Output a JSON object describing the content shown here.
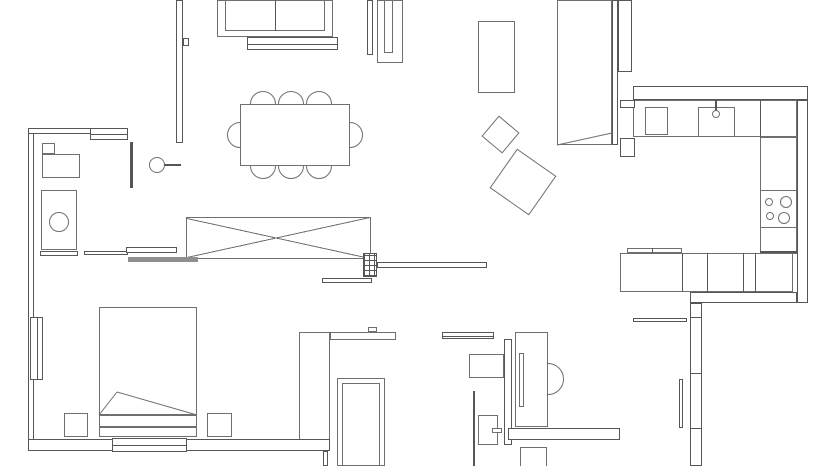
{
  "canvas": {
    "width": 840,
    "height": 466,
    "background": "#ffffff",
    "wall_color": "#565656",
    "furniture_color": "#6f6f6f",
    "gray_fill": "#8f8f8f"
  },
  "elements": [
    {
      "name": "left-exterior-wall",
      "type": "wall",
      "x": 28,
      "y": 128,
      "w": 6,
      "h": 317,
      "layer": 4
    },
    {
      "name": "bathroom-top-wall",
      "type": "wall",
      "x": 28,
      "y": 128,
      "w": 100,
      "h": 6,
      "layer": 4
    },
    {
      "name": "top-window",
      "type": "window-h",
      "x": 90,
      "y": 128,
      "w": 38,
      "h": 12,
      "layer": 5
    },
    {
      "name": "living-divider-wall",
      "type": "wall",
      "x": 176,
      "y": 0,
      "w": 7,
      "h": 143,
      "layer": 4
    },
    {
      "name": "divider-notch",
      "type": "wall",
      "x": 183,
      "y": 38,
      "w": 6,
      "h": 8,
      "layer": 4
    },
    {
      "name": "entry-door-jamb",
      "type": "wall",
      "x": 612,
      "y": 0,
      "w": 6,
      "h": 145,
      "layer": 4
    },
    {
      "name": "kitchen-left-wall",
      "type": "wall",
      "x": 618,
      "y": 0,
      "w": 14,
      "h": 72,
      "layer": 4
    },
    {
      "name": "kitchen-top-wall",
      "type": "wall",
      "x": 633,
      "y": 86,
      "w": 175,
      "h": 14,
      "layer": 4
    },
    {
      "name": "right-exterior-wall",
      "type": "wall",
      "x": 797,
      "y": 100,
      "w": 11,
      "h": 203,
      "layer": 4
    },
    {
      "name": "balcony-wall-horizontal",
      "type": "wall",
      "x": 690,
      "y": 292,
      "w": 107,
      "h": 11,
      "layer": 4
    },
    {
      "name": "balcony-wall-vertical",
      "type": "wall",
      "x": 690,
      "y": 303,
      "w": 12,
      "h": 163,
      "layer": 4
    },
    {
      "name": "balcony-wall-tick-1",
      "type": "solid",
      "x": 690,
      "y": 317,
      "w": 12,
      "h": 1,
      "layer": 5
    },
    {
      "name": "balcony-wall-tick-2",
      "type": "solid",
      "x": 690,
      "y": 373,
      "w": 12,
      "h": 1,
      "layer": 5
    },
    {
      "name": "balcony-wall-tick-3",
      "type": "solid",
      "x": 690,
      "y": 428,
      "w": 12,
      "h": 1,
      "layer": 5
    },
    {
      "name": "bottom-exterior-wall",
      "type": "wall",
      "x": 28,
      "y": 439,
      "w": 302,
      "h": 12,
      "layer": 4
    },
    {
      "name": "bottom-window",
      "type": "window-h",
      "x": 112,
      "y": 438,
      "w": 75,
      "h": 14,
      "layer": 5
    },
    {
      "name": "left-window",
      "type": "window-v",
      "x": 30,
      "y": 317,
      "w": 13,
      "h": 63,
      "layer": 5
    },
    {
      "name": "bottom-step-wall",
      "type": "wall",
      "x": 323,
      "y": 451,
      "w": 5,
      "h": 15,
      "layer": 4
    },
    {
      "name": "wc-left-wall",
      "type": "solid",
      "x": 473,
      "y": 391,
      "w": 2,
      "h": 75,
      "layer": 4
    },
    {
      "name": "wc-mid-wall",
      "type": "wall",
      "x": 504,
      "y": 339,
      "w": 8,
      "h": 106,
      "layer": 4
    },
    {
      "name": "wc-bottom-wall",
      "type": "wall",
      "x": 508,
      "y": 428,
      "w": 112,
      "h": 12,
      "layer": 4
    },
    {
      "name": "kitchen-entry-block-a",
      "type": "wall",
      "x": 620,
      "y": 100,
      "w": 15,
      "h": 8,
      "layer": 4
    },
    {
      "name": "kitchen-entry-block-b",
      "type": "wall",
      "x": 620,
      "y": 138,
      "w": 15,
      "h": 19,
      "layer": 4
    },
    {
      "name": "bathroom-partition",
      "type": "solid",
      "x": 130,
      "y": 142,
      "w": 3,
      "h": 46,
      "layer": 4
    },
    {
      "name": "sliding-door-panel-a",
      "type": "wall",
      "x": 84,
      "y": 251,
      "w": 44,
      "h": 4,
      "layer": 5
    },
    {
      "name": "sliding-door-panel-b",
      "type": "wall",
      "x": 126,
      "y": 247,
      "w": 51,
      "h": 6,
      "layer": 5
    },
    {
      "name": "sliding-door-panel-c",
      "type": "solid-gray",
      "x": 128,
      "y": 257,
      "w": 70,
      "h": 5,
      "layer": 5
    },
    {
      "name": "bathroom-bench",
      "type": "wall",
      "x": 40,
      "y": 251,
      "w": 38,
      "h": 5,
      "layer": 5
    },
    {
      "name": "hall-wall-bar",
      "type": "wall",
      "x": 377,
      "y": 262,
      "w": 110,
      "h": 6,
      "layer": 4
    },
    {
      "name": "hall-step",
      "type": "wall",
      "x": 322,
      "y": 278,
      "w": 50,
      "h": 5,
      "layer": 4
    },
    {
      "name": "balcony-door-leaf",
      "type": "wall",
      "x": 679,
      "y": 379,
      "w": 4,
      "h": 49,
      "layer": 5
    },
    {
      "name": "balcony-rail",
      "type": "wall",
      "x": 633,
      "y": 318,
      "w": 54,
      "h": 4,
      "layer": 4
    },
    {
      "name": "sofa",
      "type": "furniture",
      "x": 217,
      "y": 0,
      "w": 116,
      "h": 37,
      "layer": 2
    },
    {
      "name": "sofa-seat",
      "type": "furniture",
      "x": 225,
      "y": 0,
      "w": 100,
      "h": 31,
      "layer": 2
    },
    {
      "name": "sofa-seat-divider",
      "type": "solid",
      "x": 275,
      "y": 0,
      "w": 1,
      "h": 31,
      "layer": 3
    },
    {
      "name": "sofa-console",
      "type": "window-h",
      "x": 247,
      "y": 37,
      "w": 91,
      "h": 13,
      "layer": 2
    },
    {
      "name": "tv-rail",
      "type": "wall",
      "x": 367,
      "y": 0,
      "w": 6,
      "h": 55,
      "layer": 4
    },
    {
      "name": "tv-cabinet",
      "type": "furniture",
      "x": 377,
      "y": 0,
      "w": 26,
      "h": 63,
      "layer": 2
    },
    {
      "name": "tv-cabinet-slot",
      "type": "furniture",
      "x": 384,
      "y": 0,
      "w": 9,
      "h": 53,
      "layer": 3
    },
    {
      "name": "dining-table",
      "type": "furniture",
      "x": 240,
      "y": 104,
      "w": 110,
      "h": 62,
      "layer": 2
    },
    {
      "name": "dining-chair-top-1",
      "type": "circle",
      "cx": 263,
      "cy": 104,
      "r": 13,
      "layer": 1
    },
    {
      "name": "dining-chair-top-2",
      "type": "circle",
      "cx": 291,
      "cy": 104,
      "r": 13,
      "layer": 1
    },
    {
      "name": "dining-chair-top-3",
      "type": "circle",
      "cx": 319,
      "cy": 104,
      "r": 13,
      "layer": 1
    },
    {
      "name": "dining-chair-bottom-1",
      "type": "circle",
      "cx": 263,
      "cy": 166,
      "r": 13,
      "layer": 1
    },
    {
      "name": "dining-chair-bottom-2",
      "type": "circle",
      "cx": 291,
      "cy": 166,
      "r": 13,
      "layer": 1
    },
    {
      "name": "dining-chair-bottom-3",
      "type": "circle",
      "cx": 319,
      "cy": 166,
      "r": 13,
      "layer": 1
    },
    {
      "name": "dining-chair-left",
      "type": "circle",
      "cx": 240,
      "cy": 135,
      "r": 13,
      "layer": 1
    },
    {
      "name": "dining-chair-right",
      "type": "circle",
      "cx": 350,
      "cy": 135,
      "r": 13,
      "layer": 1
    },
    {
      "name": "entry-rug",
      "type": "furniture",
      "x": 478,
      "y": 21,
      "w": 37,
      "h": 72,
      "layer": 2
    },
    {
      "name": "pouf-small",
      "type": "rotrect",
      "cx": 500,
      "cy": 134,
      "s": 27,
      "rot": 40,
      "layer": 2
    },
    {
      "name": "pouf-large",
      "type": "rotrect",
      "cx": 523,
      "cy": 182,
      "s": 48,
      "rot": 35,
      "layer": 2
    },
    {
      "name": "entry-door-leaf",
      "type": "furniture",
      "x": 557,
      "y": 0,
      "w": 55,
      "h": 145,
      "layer": 2
    },
    {
      "name": "bathroom-cabinet",
      "type": "furniture",
      "x": 42,
      "y": 143,
      "w": 13,
      "h": 11,
      "layer": 2
    },
    {
      "name": "bathroom-counter",
      "type": "furniture",
      "x": 42,
      "y": 154,
      "w": 38,
      "h": 24,
      "layer": 2
    },
    {
      "name": "washing-machine",
      "type": "furniture",
      "x": 41,
      "y": 190,
      "w": 36,
      "h": 60,
      "layer": 2
    },
    {
      "name": "washing-machine-drum",
      "type": "circle",
      "cx": 59,
      "cy": 222,
      "r": 10,
      "layer": 3
    },
    {
      "name": "bathroom-fixture",
      "type": "circle",
      "cx": 157,
      "cy": 165,
      "r": 8,
      "layer": 2
    },
    {
      "name": "bathroom-fixture-stem",
      "type": "solid",
      "x": 164,
      "y": 164,
      "w": 17,
      "h": 2,
      "layer": 2
    },
    {
      "name": "wardrobe-crossed",
      "type": "xbox",
      "x": 186,
      "y": 217,
      "w": 185,
      "h": 42,
      "layer": 2
    },
    {
      "name": "structural-column",
      "type": "hatch",
      "x": 363,
      "y": 253,
      "w": 14,
      "h": 24,
      "layer": 5
    },
    {
      "name": "bed",
      "type": "furniture",
      "x": 99,
      "y": 307,
      "w": 98,
      "h": 108,
      "layer": 2
    },
    {
      "name": "bed-foot-a",
      "type": "furniture",
      "x": 99,
      "y": 415,
      "w": 98,
      "h": 12,
      "layer": 2
    },
    {
      "name": "bed-foot-b",
      "type": "furniture",
      "x": 99,
      "y": 427,
      "w": 98,
      "h": 10,
      "layer": 2
    },
    {
      "name": "nightstand-left",
      "type": "furniture",
      "x": 64,
      "y": 413,
      "w": 24,
      "h": 24,
      "layer": 2
    },
    {
      "name": "nightstand-right",
      "type": "furniture",
      "x": 207,
      "y": 413,
      "w": 25,
      "h": 24,
      "layer": 2
    },
    {
      "name": "bedroom-wardrobe",
      "type": "furniture",
      "x": 299,
      "y": 332,
      "w": 31,
      "h": 108,
      "layer": 2
    },
    {
      "name": "bedroom-desk",
      "type": "furniture",
      "x": 330,
      "y": 332,
      "w": 66,
      "h": 8,
      "layer": 2
    },
    {
      "name": "bedroom-desk-knob",
      "type": "furniture",
      "x": 368,
      "y": 327,
      "w": 9,
      "h": 5,
      "layer": 3
    },
    {
      "name": "shower-outer",
      "type": "furniture",
      "x": 337,
      "y": 378,
      "w": 48,
      "h": 88,
      "layer": 2
    },
    {
      "name": "shower-inner",
      "type": "furniture",
      "x": 342,
      "y": 383,
      "w": 38,
      "h": 83,
      "layer": 2
    },
    {
      "name": "towel-bar",
      "type": "window-h",
      "x": 442,
      "y": 332,
      "w": 52,
      "h": 7,
      "layer": 2
    },
    {
      "name": "wc-sink",
      "type": "furniture",
      "x": 469,
      "y": 354,
      "w": 35,
      "h": 24,
      "layer": 2
    },
    {
      "name": "toilet",
      "type": "furniture",
      "x": 478,
      "y": 415,
      "w": 20,
      "h": 30,
      "layer": 2
    },
    {
      "name": "toilet-flush",
      "type": "furniture",
      "x": 492,
      "y": 428,
      "w": 10,
      "h": 5,
      "layer": 3
    },
    {
      "name": "vanity",
      "type": "furniture",
      "x": 515,
      "y": 332,
      "w": 33,
      "h": 95,
      "layer": 2
    },
    {
      "name": "vanity-slot",
      "type": "furniture",
      "x": 519,
      "y": 353,
      "w": 5,
      "h": 54,
      "layer": 3
    },
    {
      "name": "vanity-basin",
      "type": "circle",
      "cx": 548,
      "cy": 379,
      "r": 16,
      "layer": 1
    },
    {
      "name": "corner-nook",
      "type": "corner",
      "x": 520,
      "y": 447,
      "w": 27,
      "h": 19,
      "layer": 2
    },
    {
      "name": "kitchen-counter-top",
      "type": "furniture",
      "x": 633,
      "y": 100,
      "w": 164,
      "h": 37,
      "layer": 2
    },
    {
      "name": "kitchen-cabinet",
      "type": "furniture",
      "x": 645,
      "y": 107,
      "w": 23,
      "h": 28,
      "layer": 3
    },
    {
      "name": "kitchen-sink",
      "type": "furniture",
      "x": 698,
      "y": 107,
      "w": 37,
      "h": 30,
      "layer": 3
    },
    {
      "name": "kitchen-tap",
      "type": "circle",
      "cx": 716,
      "cy": 114,
      "r": 4,
      "layer": 4
    },
    {
      "name": "kitchen-tap-stem",
      "type": "solid",
      "x": 715,
      "y": 100,
      "w": 2,
      "h": 11,
      "layer": 3
    },
    {
      "name": "counter-divider",
      "type": "solid",
      "x": 760,
      "y": 100,
      "w": 1,
      "h": 37,
      "layer": 3
    },
    {
      "name": "kitchen-counter-right",
      "type": "furniture",
      "x": 760,
      "y": 137,
      "w": 37,
      "h": 117,
      "layer": 2
    },
    {
      "name": "cooktop",
      "type": "furniture",
      "x": 760,
      "y": 190,
      "w": 37,
      "h": 38,
      "layer": 3
    },
    {
      "name": "burner-1",
      "type": "circle",
      "cx": 769,
      "cy": 202,
      "r": 4,
      "layer": 4
    },
    {
      "name": "burner-2",
      "type": "circle",
      "cx": 786,
      "cy": 202,
      "r": 6,
      "layer": 4
    },
    {
      "name": "burner-3",
      "type": "circle",
      "cx": 770,
      "cy": 216,
      "r": 4,
      "layer": 4
    },
    {
      "name": "burner-4",
      "type": "circle",
      "cx": 784,
      "cy": 218,
      "r": 6,
      "layer": 4
    },
    {
      "name": "counter-end-line",
      "type": "solid",
      "x": 760,
      "y": 251,
      "w": 37,
      "h": 2,
      "layer": 3
    },
    {
      "name": "lower-cabinet-row",
      "type": "furniture",
      "x": 620,
      "y": 253,
      "w": 173,
      "h": 39,
      "layer": 2
    },
    {
      "name": "cabinet-divider-1",
      "type": "solid",
      "x": 682,
      "y": 253,
      "w": 1,
      "h": 39,
      "layer": 3
    },
    {
      "name": "cabinet-divider-2",
      "type": "solid",
      "x": 707,
      "y": 253,
      "w": 1,
      "h": 39,
      "layer": 3
    },
    {
      "name": "cabinet-divider-3",
      "type": "solid",
      "x": 743,
      "y": 253,
      "w": 1,
      "h": 39,
      "layer": 3
    },
    {
      "name": "cabinet-divider-4",
      "type": "solid",
      "x": 755,
      "y": 253,
      "w": 1,
      "h": 39,
      "layer": 3
    },
    {
      "name": "cabinet-back-bar",
      "type": "furniture",
      "x": 627,
      "y": 248,
      "w": 55,
      "h": 5,
      "layer": 3
    },
    {
      "name": "cabinet-back-divider",
      "type": "solid",
      "x": 652,
      "y": 248,
      "w": 1,
      "h": 5,
      "layer": 4
    }
  ],
  "lines": [
    {
      "name": "entry-door-swing",
      "x1": 557,
      "y1": 145,
      "x2": 612,
      "y2": 133
    },
    {
      "name": "bed-blanket-fold-a",
      "x1": 99,
      "y1": 415,
      "x2": 117,
      "y2": 392
    },
    {
      "name": "bed-blanket-fold-b",
      "x1": 117,
      "y1": 392,
      "x2": 197,
      "y2": 415
    }
  ]
}
